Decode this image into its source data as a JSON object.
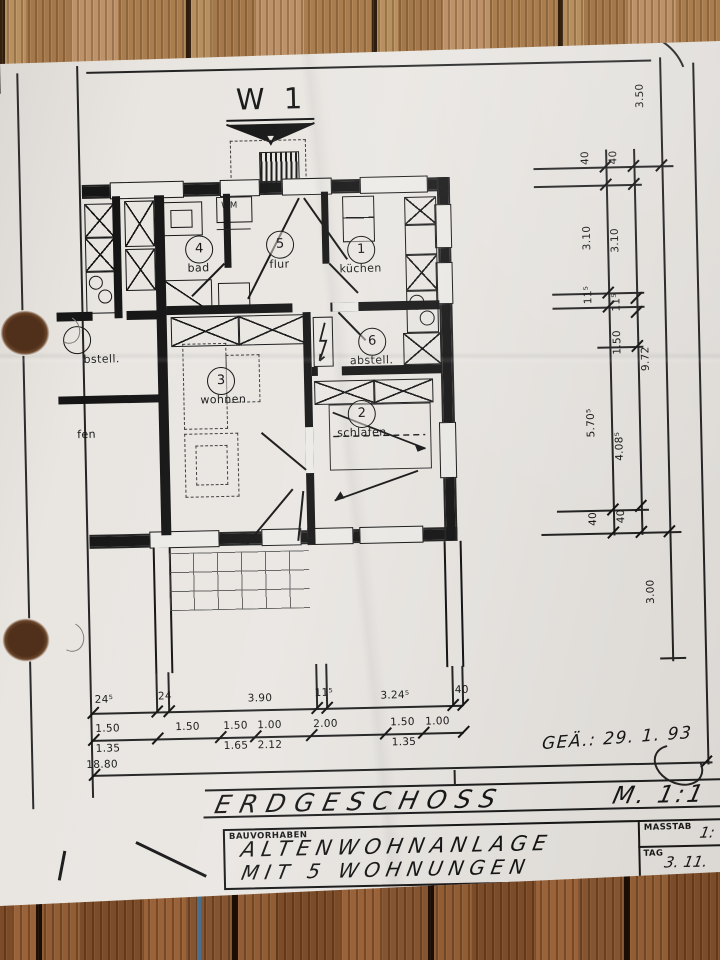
{
  "plan": {
    "sheet_title": "W 1",
    "rooms": [
      {
        "num": "4",
        "label": "bad"
      },
      {
        "num": "5",
        "label": "flur"
      },
      {
        "num": "1",
        "label": "küchen"
      },
      {
        "num": "6",
        "label": "abstell."
      },
      {
        "num": "3",
        "label": "wohnen"
      },
      {
        "num": "2",
        "label": "schlafen"
      }
    ],
    "appliance_label": "WM",
    "neighbor_left_top": "bstell.",
    "neighbor_left_bottom": "fen"
  },
  "dimensions": {
    "bottom_row1": [
      "24⁵",
      "24",
      "3.90",
      "11⁵",
      "3.24⁵",
      "40"
    ],
    "bottom_row2": [
      "1.50",
      "1.50",
      "1.50",
      "1.00",
      "2.00",
      "1.50",
      "1.00"
    ],
    "bottom_row3": [
      "1.35",
      "1.65",
      "2.12",
      "1.35"
    ],
    "bottom_total": "18.80",
    "right_inner": [
      "40",
      "3.10",
      "11⁵",
      "5.70⁵",
      "40"
    ],
    "right_outer": [
      "40",
      "3.10",
      "11⁵",
      "1.50",
      "4.08⁵",
      "40"
    ],
    "right_overall": [
      "3.50",
      "9.72",
      "3.00"
    ]
  },
  "annotations": {
    "revision_note": "GEÄ.: 29. 1. 93"
  },
  "title_strip": {
    "drawing_title": "ERDGESCHOSS",
    "scale_note": "M. 1:1"
  },
  "title_block": {
    "project_label": "BAUVORHABEN",
    "project_line1": "ALTENWOHNANLAGE",
    "project_line2": "MIT 5 WOHNUNGEN",
    "scale_label": "MASSTAB",
    "scale_value": "1:",
    "date_label": "TAG",
    "date_value": "3. 11."
  },
  "colors": {
    "ink": "#1b1b1b",
    "paper": "#e9e6e2",
    "wood_top": "#b8905f",
    "wood_bottom": "#905d35"
  }
}
